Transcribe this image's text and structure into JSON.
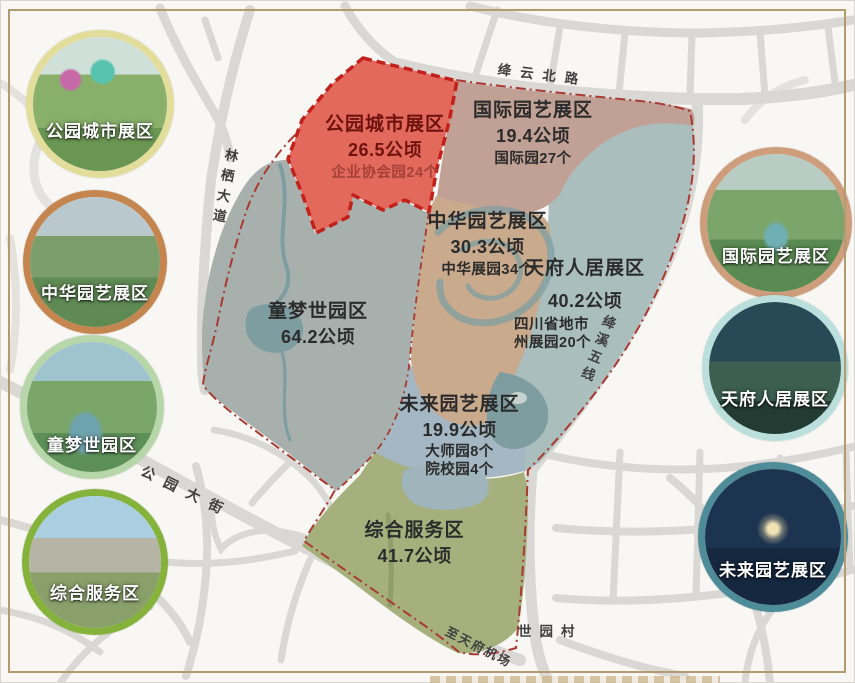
{
  "title_context": "世园会园区分区图",
  "frame": {
    "border_color": "#b29b6e"
  },
  "zones": [
    {
      "id": "parkcity",
      "name": "公园城市展区",
      "area": "26.5公顷",
      "details": [
        "企业协会园24个"
      ],
      "fill": "#e4695d",
      "border": "#c2201a"
    },
    {
      "id": "guoji",
      "name": "国际园艺展区",
      "area": "19.4公顷",
      "details": [
        "国际园27个"
      ],
      "fill": "#c1a096"
    },
    {
      "id": "zhonghua",
      "name": "中华园艺展区",
      "area": "30.3公顷",
      "details": [
        "中华展园34个"
      ],
      "fill": "#c9aa8c"
    },
    {
      "id": "tianfu",
      "name": "天府人居展区",
      "area": "40.2公顷",
      "details": [
        "四川省地市",
        "州展园20个"
      ],
      "fill": "#aabebd"
    },
    {
      "id": "tongmeng",
      "name": "童梦世园区",
      "area": "64.2公顷",
      "details": [],
      "fill": "#a7b0ac"
    },
    {
      "id": "weilai",
      "name": "未来园艺展区",
      "area": "19.9公顷",
      "details": [
        "大师园8个",
        "院校园4个"
      ],
      "fill": "#a4b7c2"
    },
    {
      "id": "zonghe",
      "name": "综合服务区",
      "area": "41.7公顷",
      "details": [],
      "fill": "#a6b07c"
    }
  ],
  "roads": {
    "north": "绛云北路",
    "west": "林栖大道",
    "southwest": "公园大街",
    "east": "绛溪五线",
    "airport": "至天府机场",
    "village": "世园村"
  },
  "legend_circles": {
    "left": [
      {
        "label": "公园城市展区",
        "border_color": "#e3dd9b"
      },
      {
        "label": "中华园艺展区",
        "border_color": "#c5854e"
      },
      {
        "label": "童梦世园区",
        "border_color": "#b7d6a9"
      },
      {
        "label": "综合服务区",
        "border_color": "#85b23b"
      }
    ],
    "right": [
      {
        "label": "国际园艺展区",
        "border_color": "#cd9d7c"
      },
      {
        "label": "天府人居展区",
        "border_color": "#badfdc"
      },
      {
        "label": "未来园艺展区",
        "border_color": "#4e8c9a"
      }
    ]
  },
  "colors": {
    "boundary_line": "#a93a32",
    "road_gray": "#d9d8d4",
    "water_teal": "#7e9da1",
    "background": "#f8f7f4"
  }
}
